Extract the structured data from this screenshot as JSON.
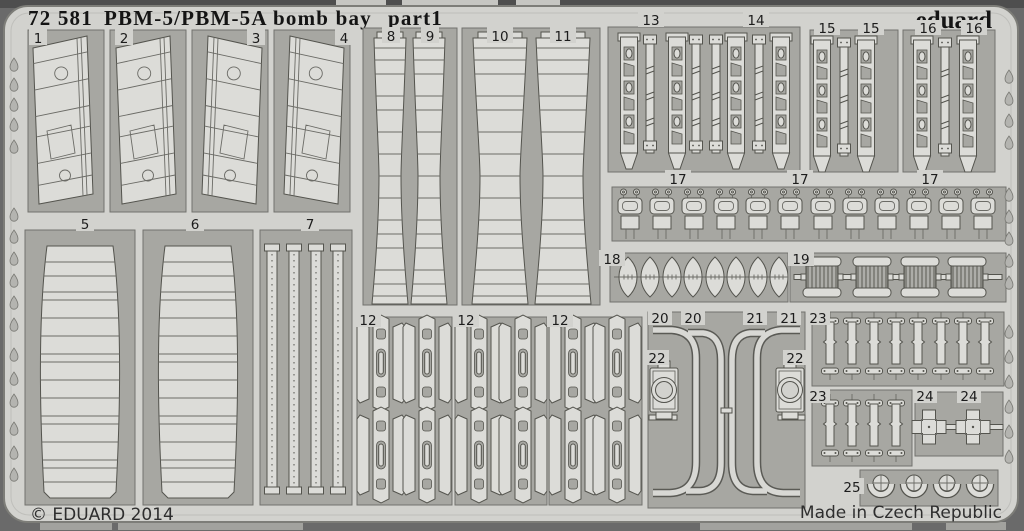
{
  "product": {
    "catalog_number": "72 581",
    "title": "PBM-5/PBM-5A bomb bay",
    "part_designation": "part1",
    "brand": "eduard",
    "copyright": "© EDUARD 2014",
    "made_in": "Made in Czech Republic"
  },
  "colors": {
    "backdrop": "#6a6a6a",
    "fret_surface": "#d2d2ce",
    "frame_recess": "#a7a7a2",
    "part_surface": "#dcdcd8",
    "etch_outline": "#54544e",
    "label_text": "#1c1c1c"
  },
  "labels": {
    "p1": "1",
    "p2": "2",
    "p3": "3",
    "p4": "4",
    "p5": "5",
    "p6": "6",
    "p7": "7",
    "p8": "8",
    "p9": "9",
    "p10": "10",
    "p11": "11",
    "p12a": "12",
    "p12b": "12",
    "p12c": "12",
    "p13": "13",
    "p14": "14",
    "p15a": "15",
    "p15b": "15",
    "p16a": "16",
    "p16b": "16",
    "p17a": "17",
    "p17b": "17",
    "p17c": "17",
    "p18": "18",
    "p19": "19",
    "p20a": "20",
    "p20b": "20",
    "p21a": "21",
    "p21b": "21",
    "p22a": "22",
    "p22b": "22",
    "p23a": "23",
    "p23b": "23",
    "p24a": "24",
    "p24b": "24",
    "p25": "25"
  },
  "parts_inventory": [
    {
      "number": "1",
      "shape": "bomb bay door skin panel"
    },
    {
      "number": "2",
      "shape": "bomb bay door skin panel"
    },
    {
      "number": "3",
      "shape": "bomb bay door skin panel, mirrored"
    },
    {
      "number": "4",
      "shape": "bomb bay door skin panel, mirrored"
    },
    {
      "number": "5",
      "shape": "large ribbed fairing skin"
    },
    {
      "number": "6",
      "shape": "large ribbed fairing skin"
    },
    {
      "number": "7",
      "shape": "four rivet-detailed stiffener strips"
    },
    {
      "number": "8",
      "shape": "narrow ribbed keel strip"
    },
    {
      "number": "9",
      "shape": "narrow ribbed keel strip"
    },
    {
      "number": "10",
      "shape": "wide ribbed keel strip"
    },
    {
      "number": "11",
      "shape": "wide ribbed keel strip"
    },
    {
      "number": "12",
      "shape": "bomb rack bracket assemblies, three 2x2 panels"
    },
    {
      "number": "13",
      "shape": "perforated side frame strips"
    },
    {
      "number": "14",
      "shape": "perforated side frame strips"
    },
    {
      "number": "15",
      "shape": "perforated side frame strips"
    },
    {
      "number": "16",
      "shape": "perforated side frame strips"
    },
    {
      "number": "17",
      "shape": "row of twelve latch fittings"
    },
    {
      "number": "18",
      "shape": "row of eight lens-shaped fairings"
    },
    {
      "number": "19",
      "shape": "four ribbed spool fittings"
    },
    {
      "number": "20",
      "shape": "curved door track rail"
    },
    {
      "number": "21",
      "shape": "curved door track rail, mirrored"
    },
    {
      "number": "22",
      "shape": "roller bracket with ring"
    },
    {
      "number": "23",
      "shape": "hinge strips, rows of eight and four"
    },
    {
      "number": "24",
      "shape": "cross-shaped mounts"
    },
    {
      "number": "25",
      "shape": "four clamp rings"
    }
  ]
}
